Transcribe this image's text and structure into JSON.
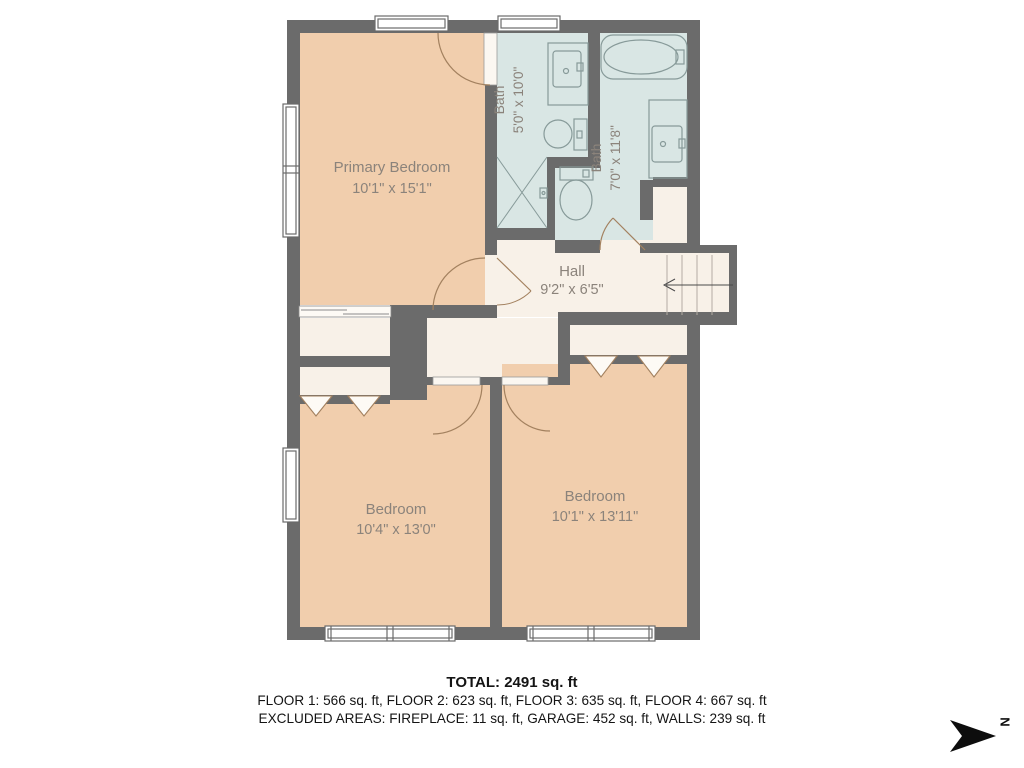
{
  "floorplan": {
    "rooms": [
      {
        "name": "Primary Bedroom",
        "dims": "10'1\" x 15'1\""
      },
      {
        "name": "Bath",
        "dims": "5'0\" x 10'0\""
      },
      {
        "name": "Bath",
        "dims": "7'0\" x 11'8\""
      },
      {
        "name": "Hall",
        "dims": "9'2\" x 6'5\""
      },
      {
        "name": "Bedroom",
        "dims": "10'4\" x 13'0\""
      },
      {
        "name": "Bedroom",
        "dims": "10'1\" x 13'11\""
      }
    ],
    "compass_label": "N"
  },
  "summary": {
    "total": "TOTAL: 2491 sq. ft",
    "floors": "FLOOR 1: 566 sq. ft, FLOOR 2: 623 sq. ft, FLOOR 3: 635 sq. ft, FLOOR 4: 667 sq. ft",
    "excluded": "EXCLUDED AREAS: FIREPLACE: 11 sq. ft, GARAGE: 452 sq. ft, WALLS: 239 sq. ft"
  },
  "colors": {
    "wall": "#6b6b6b",
    "bedroom_fill": "#f1cead",
    "bath_fill": "#d9e6e4",
    "hall_fill": "#f8f1e8",
    "door_line": "#a3815f",
    "fixture_line": "#879a99",
    "label_text": "#8b837b",
    "summary_text": "#141414",
    "compass": "#0d0d0d"
  }
}
